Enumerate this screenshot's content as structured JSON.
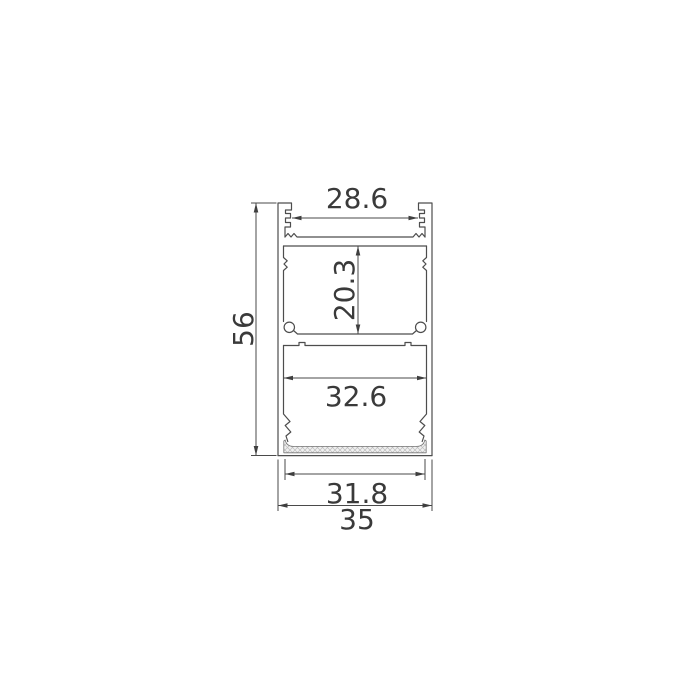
{
  "drawing": {
    "dimensions": {
      "top_opening_width": {
        "label": "28.6",
        "value": 28.6
      },
      "upper_cavity_height": {
        "label": "20.3",
        "value": 20.3
      },
      "overall_height": {
        "label": "56",
        "value": 56
      },
      "lower_cavity_width": {
        "label": "32.6",
        "value": 32.6
      },
      "diffuser_width": {
        "label": "31.8",
        "value": 31.8
      },
      "overall_width": {
        "label": "35",
        "value": 35
      }
    },
    "colors": {
      "outline": "#4d4d4d",
      "dimension_line": "#4a4a4a",
      "dimension_text": "#3a3a3a",
      "hatch_fill": "#f0f0f0",
      "hatch_line": "#bdbdbd",
      "background": "#ffffff"
    }
  }
}
